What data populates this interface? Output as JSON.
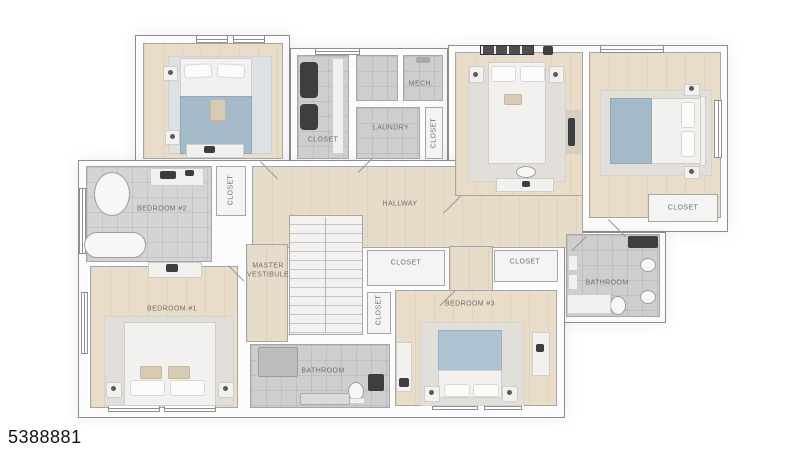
{
  "image": {
    "type": "floor-plan-render",
    "listing_id": "5388881"
  },
  "labels": {
    "closet_top": "CLOSET",
    "mech": "MECH.",
    "laundry": "LAUNDRY",
    "closet_laundry": "CLOSET",
    "closet_bed2": "CLOSET",
    "bedroom2": "BEDROOM #2",
    "hallway": "HALLWAY",
    "master_vestibule": "MASTER VESTIBULE",
    "closet_mid": "CLOSET",
    "closet_mid_small": "CLOSET",
    "closet_right_mid": "CLOSET",
    "closet_top_right": "CLOSET",
    "bathroom_right": "BATHROOM",
    "bedroom3": "BEDROOM #3",
    "bedroom1": "BEDROOM #1",
    "bathroom_bottom": "BATHROOM"
  },
  "colors": {
    "bedding_accent": "#a5bac9",
    "headboard_accent": "#aec3d1",
    "floor_wood": "#e9ddca",
    "floor_tile": "#cecece",
    "wall": "#fcfcfc"
  }
}
